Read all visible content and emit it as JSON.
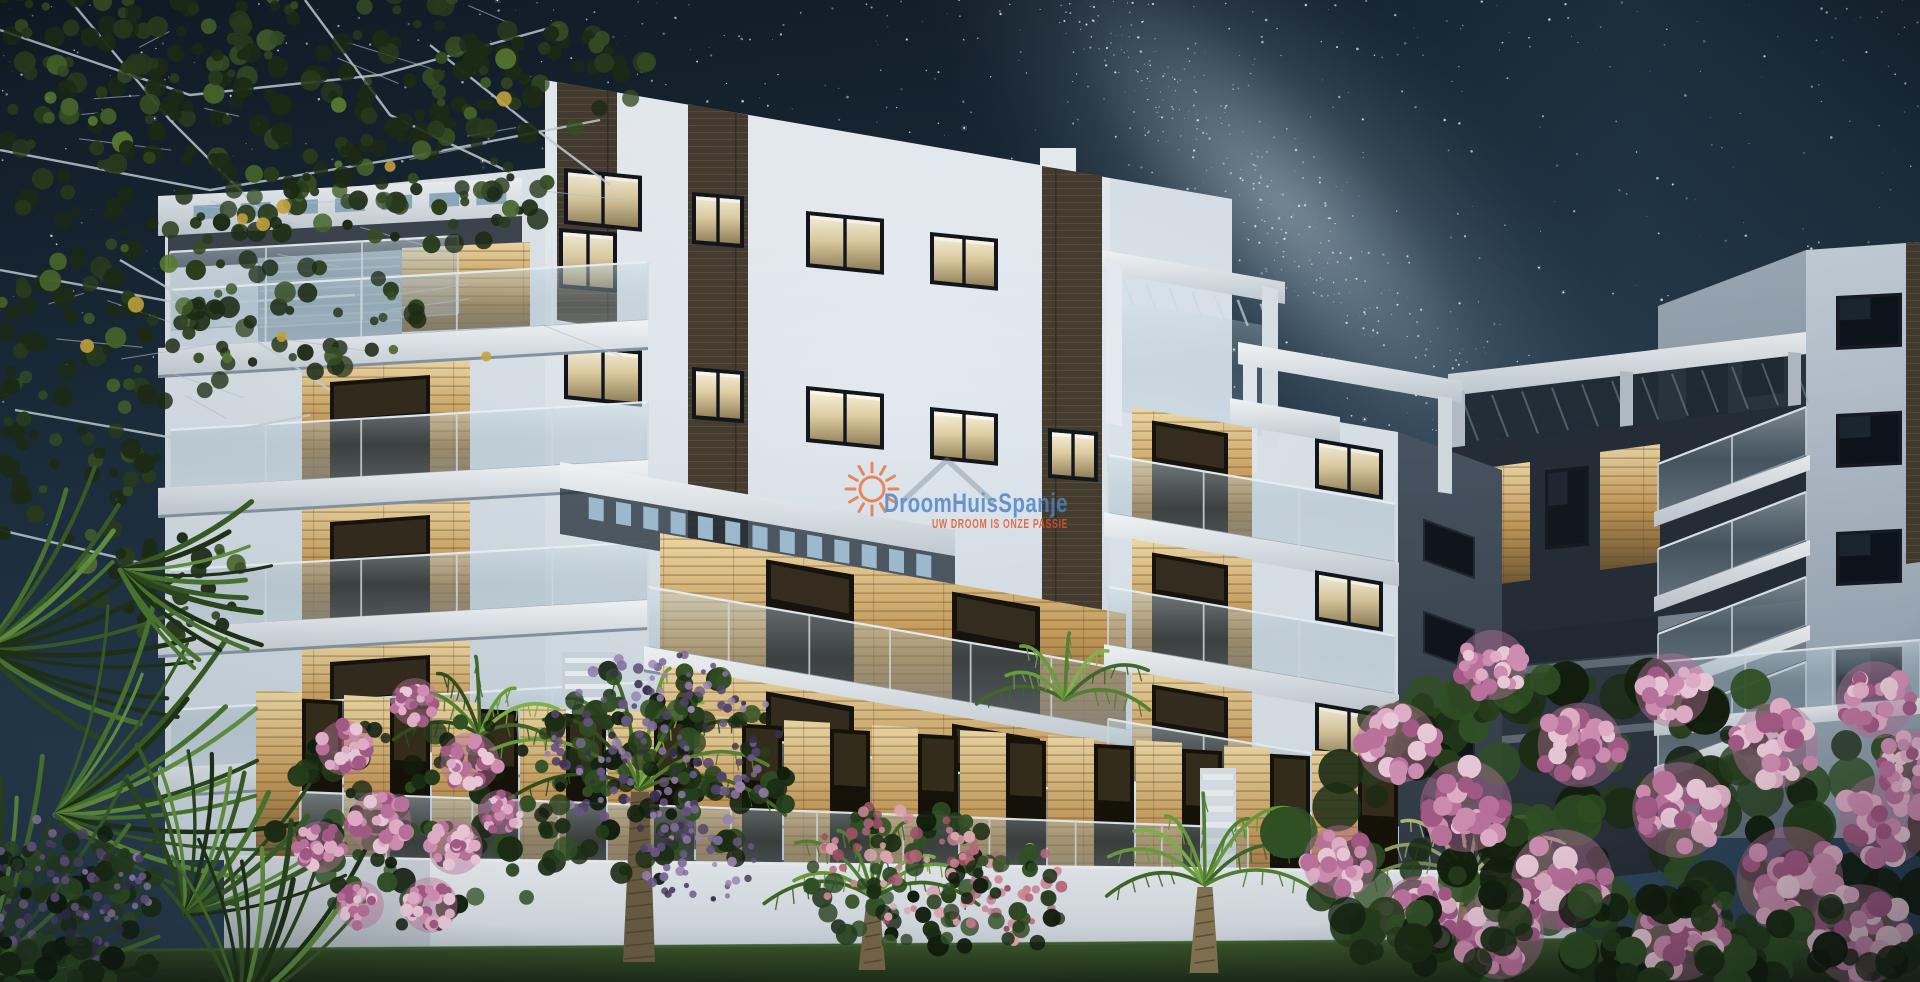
{
  "meta": {
    "type": "architectural-night-render",
    "scene": "Modern white apartment complex at night under a starry Milky Way sky, warm lit windows, glass balconies, palm trees and pink and purple flowering shrubs in the foreground"
  },
  "watermark": {
    "brand": "DroomHuisSpanje",
    "tagline": "UW DROOM IS ONZE PASSIE",
    "brand_color": "#4b84c6",
    "tagline_color": "#e2562a",
    "sun_icon_color": "#e8672f",
    "house_icon_color": "#7c8791"
  },
  "palette": {
    "sky_top": "#101b26",
    "sky_bottom": "#2c4356",
    "milky_way": "#cfe2f0",
    "star": "#dcebf7",
    "facade_white": "#e4ebf1",
    "facade_shadow": "#9fb0bd",
    "wood_accent_lit": "#c89d5b",
    "wood_panel_dark": "#463d31",
    "window_glow": "#f3ead2",
    "window_dark": "#0e141b",
    "glass_railing": "#9fb6c2",
    "dark_side_wall": "#46525f",
    "right_building_front": "#c8d4df",
    "right_building_side": "#9cabb8",
    "garden_wall": "#e3e9ee",
    "lawn_green": "#2e4527",
    "tree_green": "#2a3e1c",
    "palm_green": "#588633",
    "flower_pink": "#da95ba",
    "flower_purple": "#6f598c",
    "flower_rose": "#d88d9d"
  }
}
